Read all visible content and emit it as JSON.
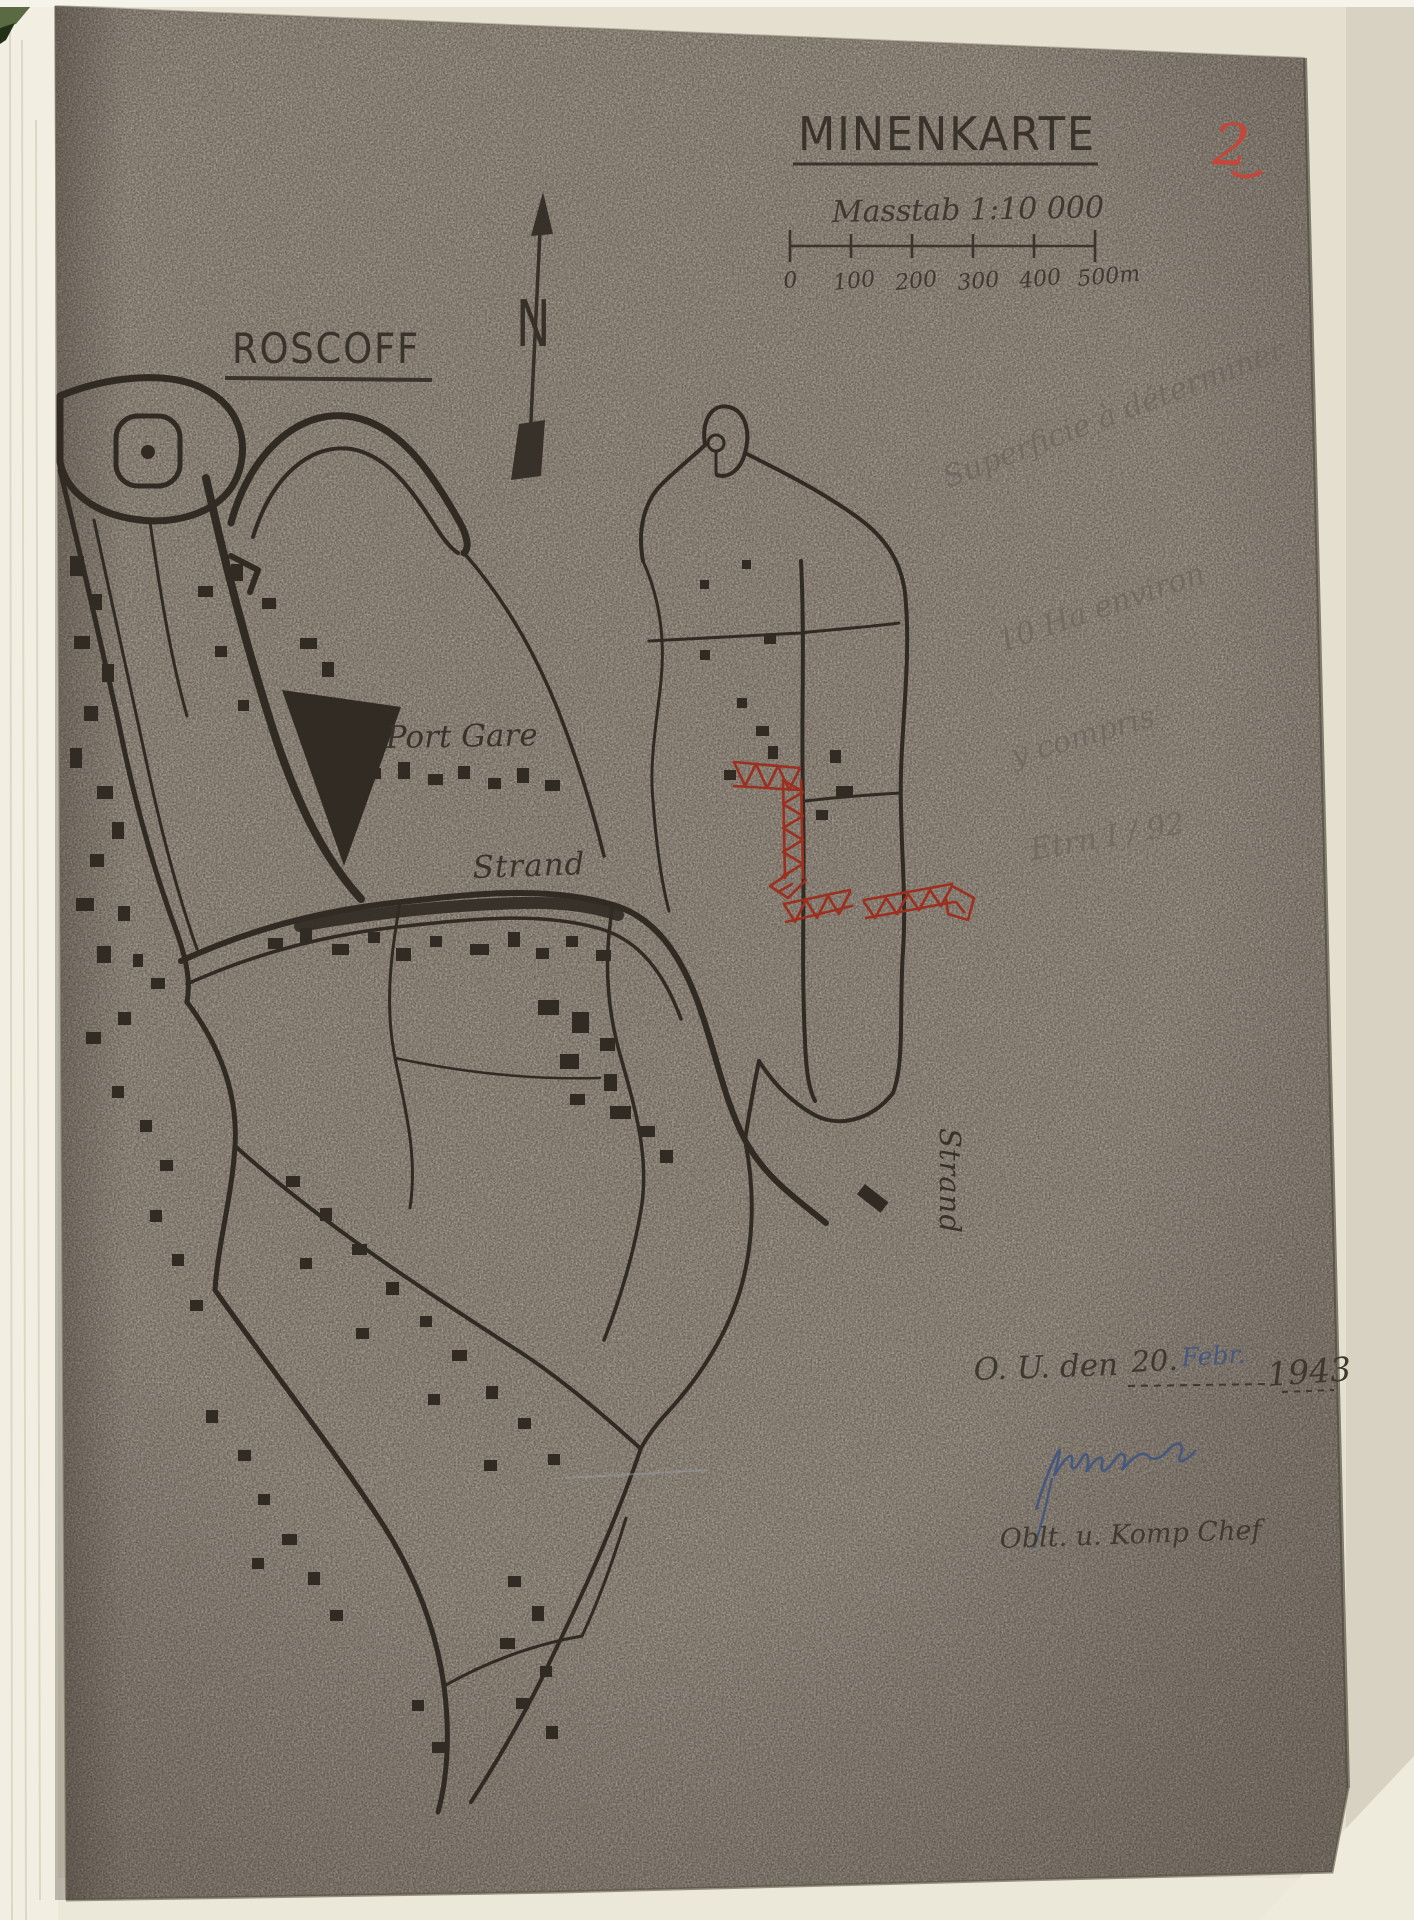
{
  "document": {
    "page_number": "2",
    "title": "MINENKARTE",
    "scale_text": "Masstab 1:10 000",
    "town_label": "ROSCOFF",
    "compass_label": "N"
  },
  "scale_bar": {
    "tick_labels": [
      "0",
      "100",
      "200",
      "300",
      "400",
      "500m"
    ]
  },
  "map_labels": {
    "port_gare": "Port Gare",
    "strand_horizontal": "Strand",
    "strand_vertical": "Strand"
  },
  "pencil_notes": {
    "line1": "Superficie à déterminer",
    "line2": "10 Ha environ",
    "line3": "y compris",
    "line4": "Etrn I / 92"
  },
  "footer": {
    "dateline_prefix": "O. U. den",
    "date_day": "20.",
    "date_month": "Febr.",
    "date_year": "1943",
    "signer_title": "Oblt. u. Komp Chef"
  },
  "colors": {
    "paper": "#8f8478",
    "ink": "#322b24",
    "mine_red": "#9c3020",
    "page_number_red": "#c3473a",
    "pencil": "#6f675d",
    "blue_ink": "#46587e"
  }
}
